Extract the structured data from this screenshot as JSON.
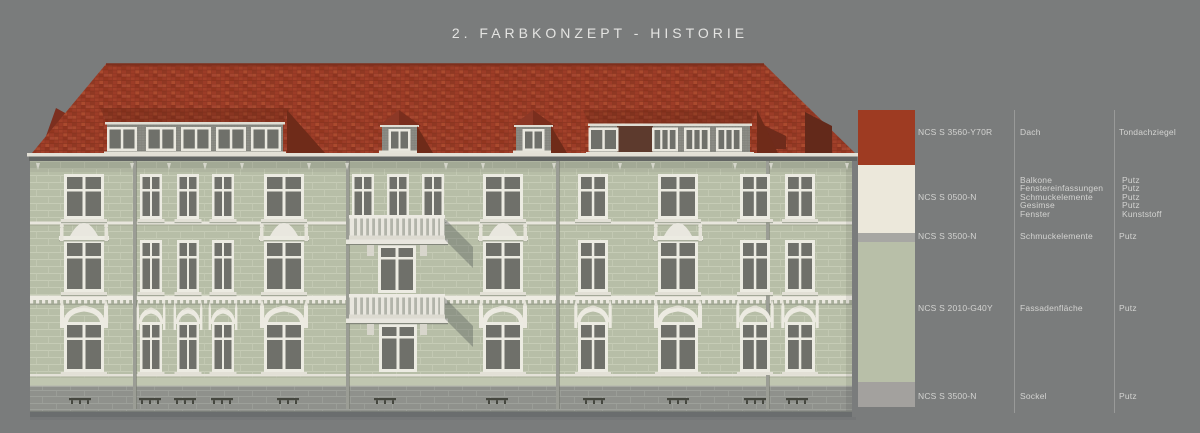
{
  "title": "2. FARBKONZEPT - HISTORIE",
  "background_color": "#7a7c7c",
  "drawing": {
    "label": "building-front-elevation",
    "roof_color": "#9c3c27",
    "facade_color": "#b7bea7",
    "trim_color": "#ecebe2",
    "sockel_color": "#8f918c"
  },
  "legend": {
    "rows": [
      {
        "code": "NCS S 3560-Y70R",
        "parts": [
          "Dach"
        ],
        "materials": [
          "Tondachziegel"
        ],
        "color": "#9e3b22"
      },
      {
        "code": "NCS S 0500-N",
        "parts": [
          "Balkone",
          "Fenstereinfassungen",
          "Schmuckelemente",
          "Gesimse",
          "Fenster"
        ],
        "materials": [
          "Putz",
          "Putz",
          "Putz",
          "Putz",
          "Kunststoff"
        ],
        "color": "#ece8db"
      },
      {
        "code": "NCS S 3500-N",
        "parts": [
          "Schmuckelemente"
        ],
        "materials": [
          "Putz"
        ],
        "color": "#a7a7a3"
      },
      {
        "code": "NCS S 2010-G40Y",
        "parts": [
          "Fassadenfläche"
        ],
        "materials": [
          "Putz"
        ],
        "color": "#b8bfa8"
      },
      {
        "code": "NCS S 3500-N",
        "parts": [
          "Sockel"
        ],
        "materials": [
          "Putz"
        ],
        "color": "#a3a19e"
      }
    ]
  }
}
